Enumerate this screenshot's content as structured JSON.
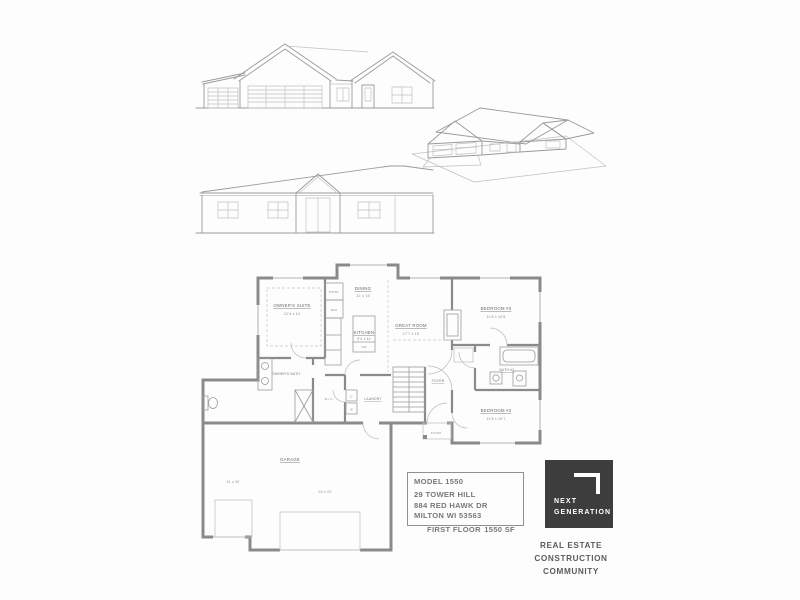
{
  "page": {
    "background": "#fdfdfd"
  },
  "title_block": {
    "model": "MODEL 1550",
    "address_line1": "29 TOWER HILL",
    "address_line2": "884 RED HAWK DR",
    "address_line3": "MILTON WI 53563",
    "floor_label": "FIRST FLOOR",
    "area": "1550 SF"
  },
  "logo": {
    "line1": "NEXT",
    "line2": "GENERATION",
    "background": "#3d3d3d"
  },
  "tagline": {
    "line1": "REAL ESTATE",
    "line2": "CONSTRUCTION",
    "line3": "COMMUNITY"
  },
  "floor_plan": {
    "owners_suite": {
      "name": "OWNER'S SUITE",
      "dims": "12'4 x 14"
    },
    "owners_bath": {
      "name": "OWNER'S BATH"
    },
    "dining": {
      "name": "DINING",
      "dims": "11' x 10"
    },
    "kitchen": {
      "name": "KITCHEN",
      "dims": "9'4 x 11"
    },
    "great_room": {
      "name": "GREAT ROOM",
      "dims": "17'7 x 15"
    },
    "bedroom3": {
      "name": "BEDROOM #3",
      "dims": "11'8 x 10'8"
    },
    "bath2": {
      "name": "BATH #2"
    },
    "bedroom2": {
      "name": "BEDROOM #2",
      "dims": "11'8 x 10'7"
    },
    "foyer": {
      "name": "FOYER"
    },
    "laundry": {
      "name": "LAUNDRY"
    },
    "wic": {
      "name": "W.I.C."
    },
    "pantry": {
      "name": "PNTRY"
    },
    "refrigerator": "RFG",
    "dishwasher": "DW",
    "washer": "W",
    "dryer": "D",
    "garage": {
      "name": "GARAGE",
      "dims_main": "24 x 22",
      "dims_bay": "11 x 20"
    },
    "stoop": {
      "name": "STOOP"
    }
  }
}
